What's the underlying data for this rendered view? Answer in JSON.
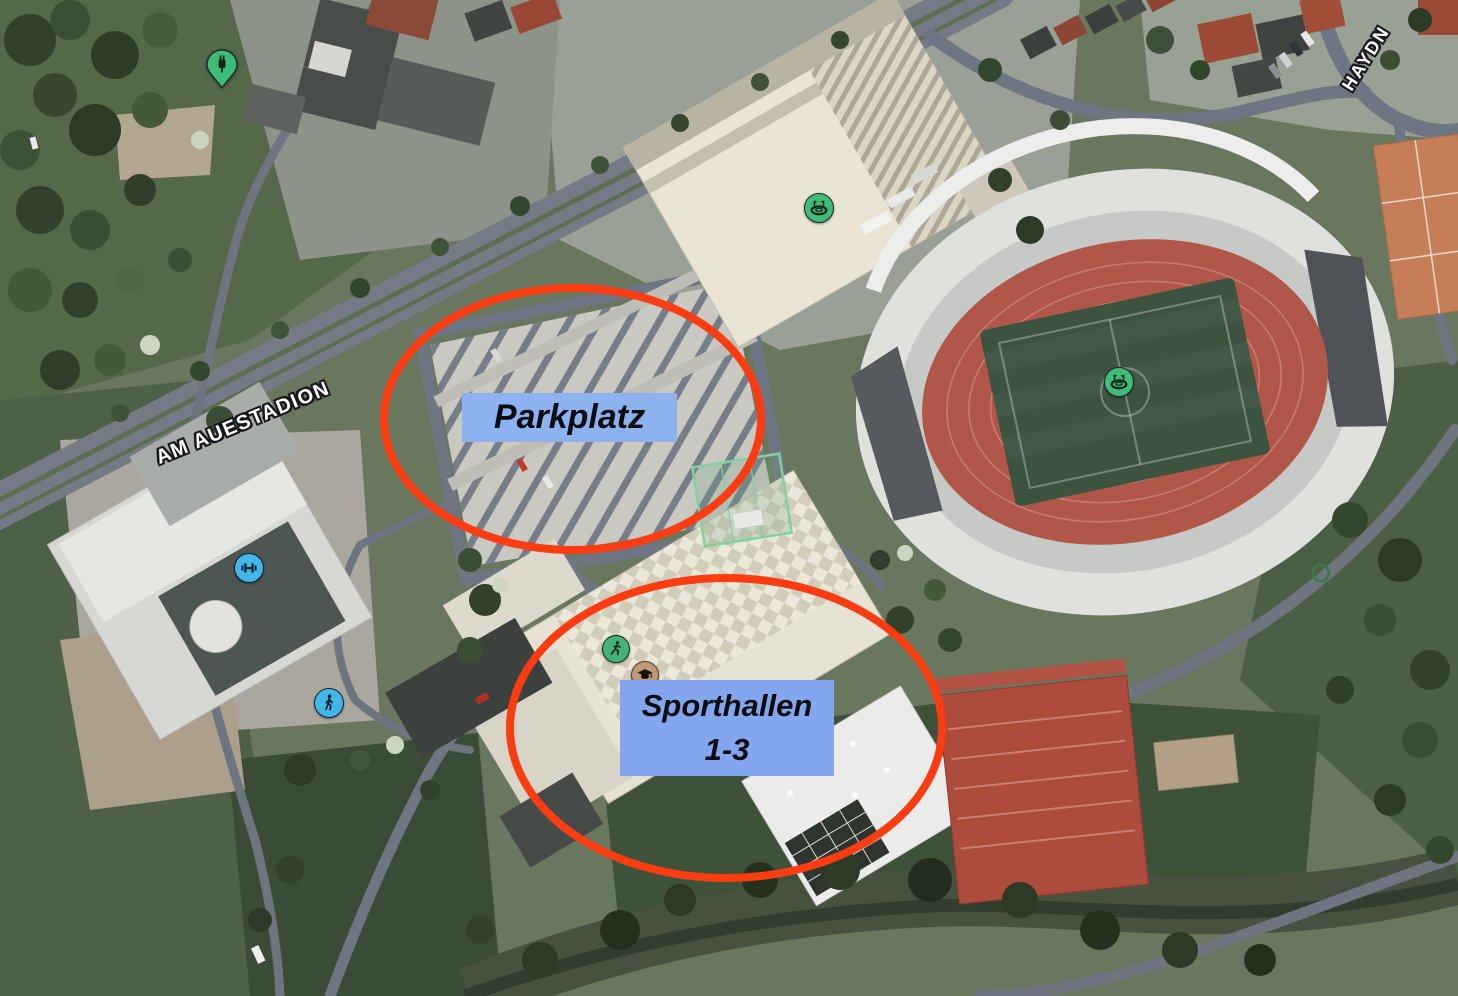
{
  "map": {
    "kind": "satellite-aerial-view",
    "street_labels": {
      "am_auestadion": "AM AUESTADION",
      "haydn": "HAYDN"
    },
    "poi_icons": [
      {
        "name": "ev-charging-station-icon",
        "shape": "pin",
        "color": "#3ebd78"
      },
      {
        "name": "stadium-icon",
        "shape": "circle",
        "color": "#3ebd78"
      },
      {
        "name": "stadium-icon",
        "shape": "circle",
        "color": "#3ebd78"
      },
      {
        "name": "fitness-dumbbell-icon",
        "shape": "circle",
        "color": "#41b7e9"
      },
      {
        "name": "pedestrian-icon",
        "shape": "circle",
        "color": "#41b7e9"
      },
      {
        "name": "running-track-icon",
        "shape": "circle",
        "color": "#43b27c"
      },
      {
        "name": "education-icon",
        "shape": "circle",
        "color": "#bf9878"
      }
    ]
  },
  "annotations": {
    "highlight_color": "#f93c12",
    "label_background": "#8db2f0",
    "parkplatz": {
      "label": "Parkplatz"
    },
    "sporthallen": {
      "line1": "Sporthallen",
      "line2": "1-3"
    }
  }
}
